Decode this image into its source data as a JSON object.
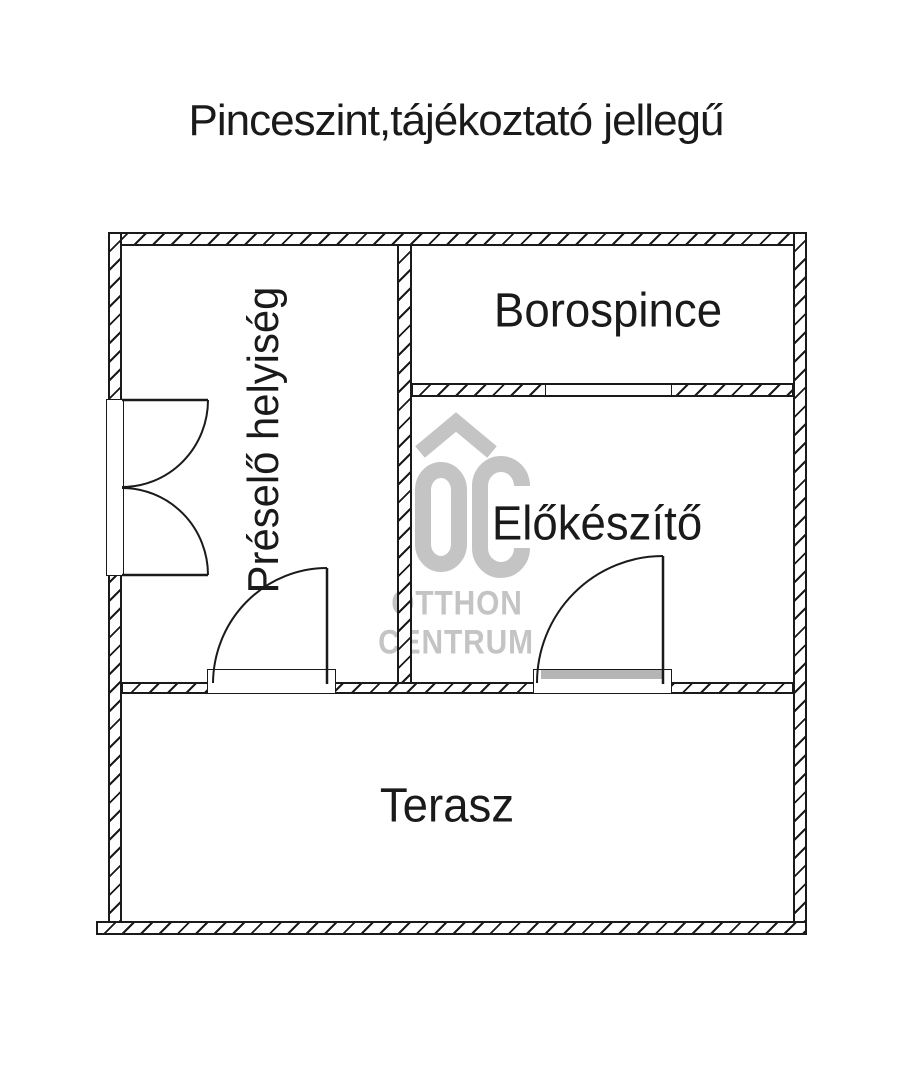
{
  "title": "Pinceszint,tájékoztató jellegű",
  "rooms": [
    {
      "id": "preselo-helyiseg",
      "label": "Préselő helyiség"
    },
    {
      "id": "borospince",
      "label": "Borospince"
    },
    {
      "id": "elokeszito",
      "label": "Előkészítő"
    },
    {
      "id": "terasz",
      "label": "Terasz"
    }
  ],
  "watermark": {
    "initials": "OC",
    "line1": "OTTHON",
    "line2": "CENTRUM",
    "color": "#c4c4c4"
  },
  "colors": {
    "line": "#1a1a1a",
    "background": "#ffffff",
    "door_sill": "#b5b5b5"
  }
}
